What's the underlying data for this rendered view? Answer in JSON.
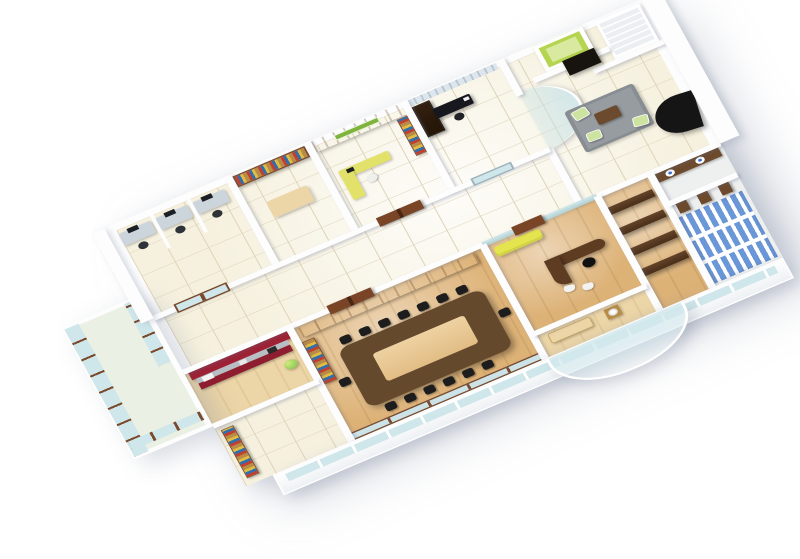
{
  "meta": {
    "type": "3d-isometric-office-floor-plan-render",
    "description": "Cutaway 3D rendering of a single office floor viewed from above at an angle, on a plain white background. No text is rendered in the image.",
    "visible_text": "none"
  },
  "palette": {
    "bg": "#ffffff",
    "wall": "#fdfdfe",
    "wall-edge": "#e3e6ea",
    "tile": "#f6f1df",
    "tile-line": "#ddd3b8",
    "tile-light": "#eef0f0",
    "wood": "#ddb277",
    "wood-light": "#ecd5a7",
    "glass": "#cfe6ea",
    "glass-deep": "#aed3da",
    "glass-frame": "#7a4a2c",
    "red-wall": "#9e2135",
    "red-base": "#8f1d30",
    "counter-top": "#b8bec4",
    "sofa-yellow": "#e4e44e",
    "sofa-black": "#151515",
    "rug": "#979ca1",
    "chair-green": "#cde3a0",
    "chair-black": "#1d1d1d",
    "desk-black": "#17181d",
    "cabinet-dark": "#332010",
    "shelf-wood": "#b98c46",
    "credenza": "#c79c55",
    "table-wood": "#64492d",
    "table-inset": "#eed2a2",
    "door-wood": "#7a4526",
    "stall-blue": "#6a97d8",
    "stall-wood": "#6e4a2c",
    "partition-wood": "#64422a",
    "basin-blue": "#3b6fd4",
    "stair": "#eceff2",
    "closet-green": "#b5d44f",
    "closet-green-light": "#d9eaa0",
    "sign-green": "#7fb43c",
    "water-green": "#7cbf44",
    "monitor": "#1c1f24",
    "desk-panel": "#ccd5dc",
    "book-red": "#c33f2f",
    "book-blue": "#2f6fae",
    "book-yellow": "#e0bc45",
    "balcony-floor": "#eaf0e4"
  },
  "rooms": {
    "balcony": {
      "label": "Glass balcony"
    },
    "workstations": {
      "label": "Staff workstation room"
    },
    "library": {
      "label": "Library / shelf wall room"
    },
    "reception": {
      "label": "Reception office with green sign"
    },
    "cabin": {
      "label": "Private cabin with dark desk"
    },
    "lobby": {
      "label": "Entrance lobby"
    },
    "staircase": {
      "label": "Staircase"
    },
    "closet": {
      "label": "Green store closet"
    },
    "waiting": {
      "label": "Waiting lounge with rug"
    },
    "corridor": {
      "label": "Central corridor"
    },
    "pantry": {
      "label": "Pantry / kitchenette with red wall"
    },
    "storage": {
      "label": "Store room"
    },
    "conference": {
      "label": "Conference room"
    },
    "executive": {
      "label": "Executive office"
    },
    "lounge": {
      "label": "Washroom lounge"
    },
    "cubicles": {
      "label": "Wooden cubicle partitions"
    },
    "restrooms": {
      "label": "Restrooms with blue stalls"
    },
    "facade": {
      "label": "Front facade parapet"
    },
    "atrium": {
      "label": "Curved glass atrium"
    }
  },
  "furniture": {
    "conference_table": "Long conference table with 15 black chairs",
    "executive_desk": "Curved executive desk with black chair",
    "yellow_sofa": "Yellow sofa",
    "black_sofa": "Black lobby sofa",
    "reception_desk": "Yellow-green L-shaped reception desk",
    "cabin_desk": "Black cabin desk",
    "pantry_counter": "Pantry counter with appliances",
    "water_jar": "Green water dispenser",
    "workstation_desk": "Computer workstation",
    "bookshelf": "Bookshelf wall",
    "coffee_table": "Coffee table",
    "washbasin": "Washbasin",
    "credenza": "Storage credenza"
  }
}
